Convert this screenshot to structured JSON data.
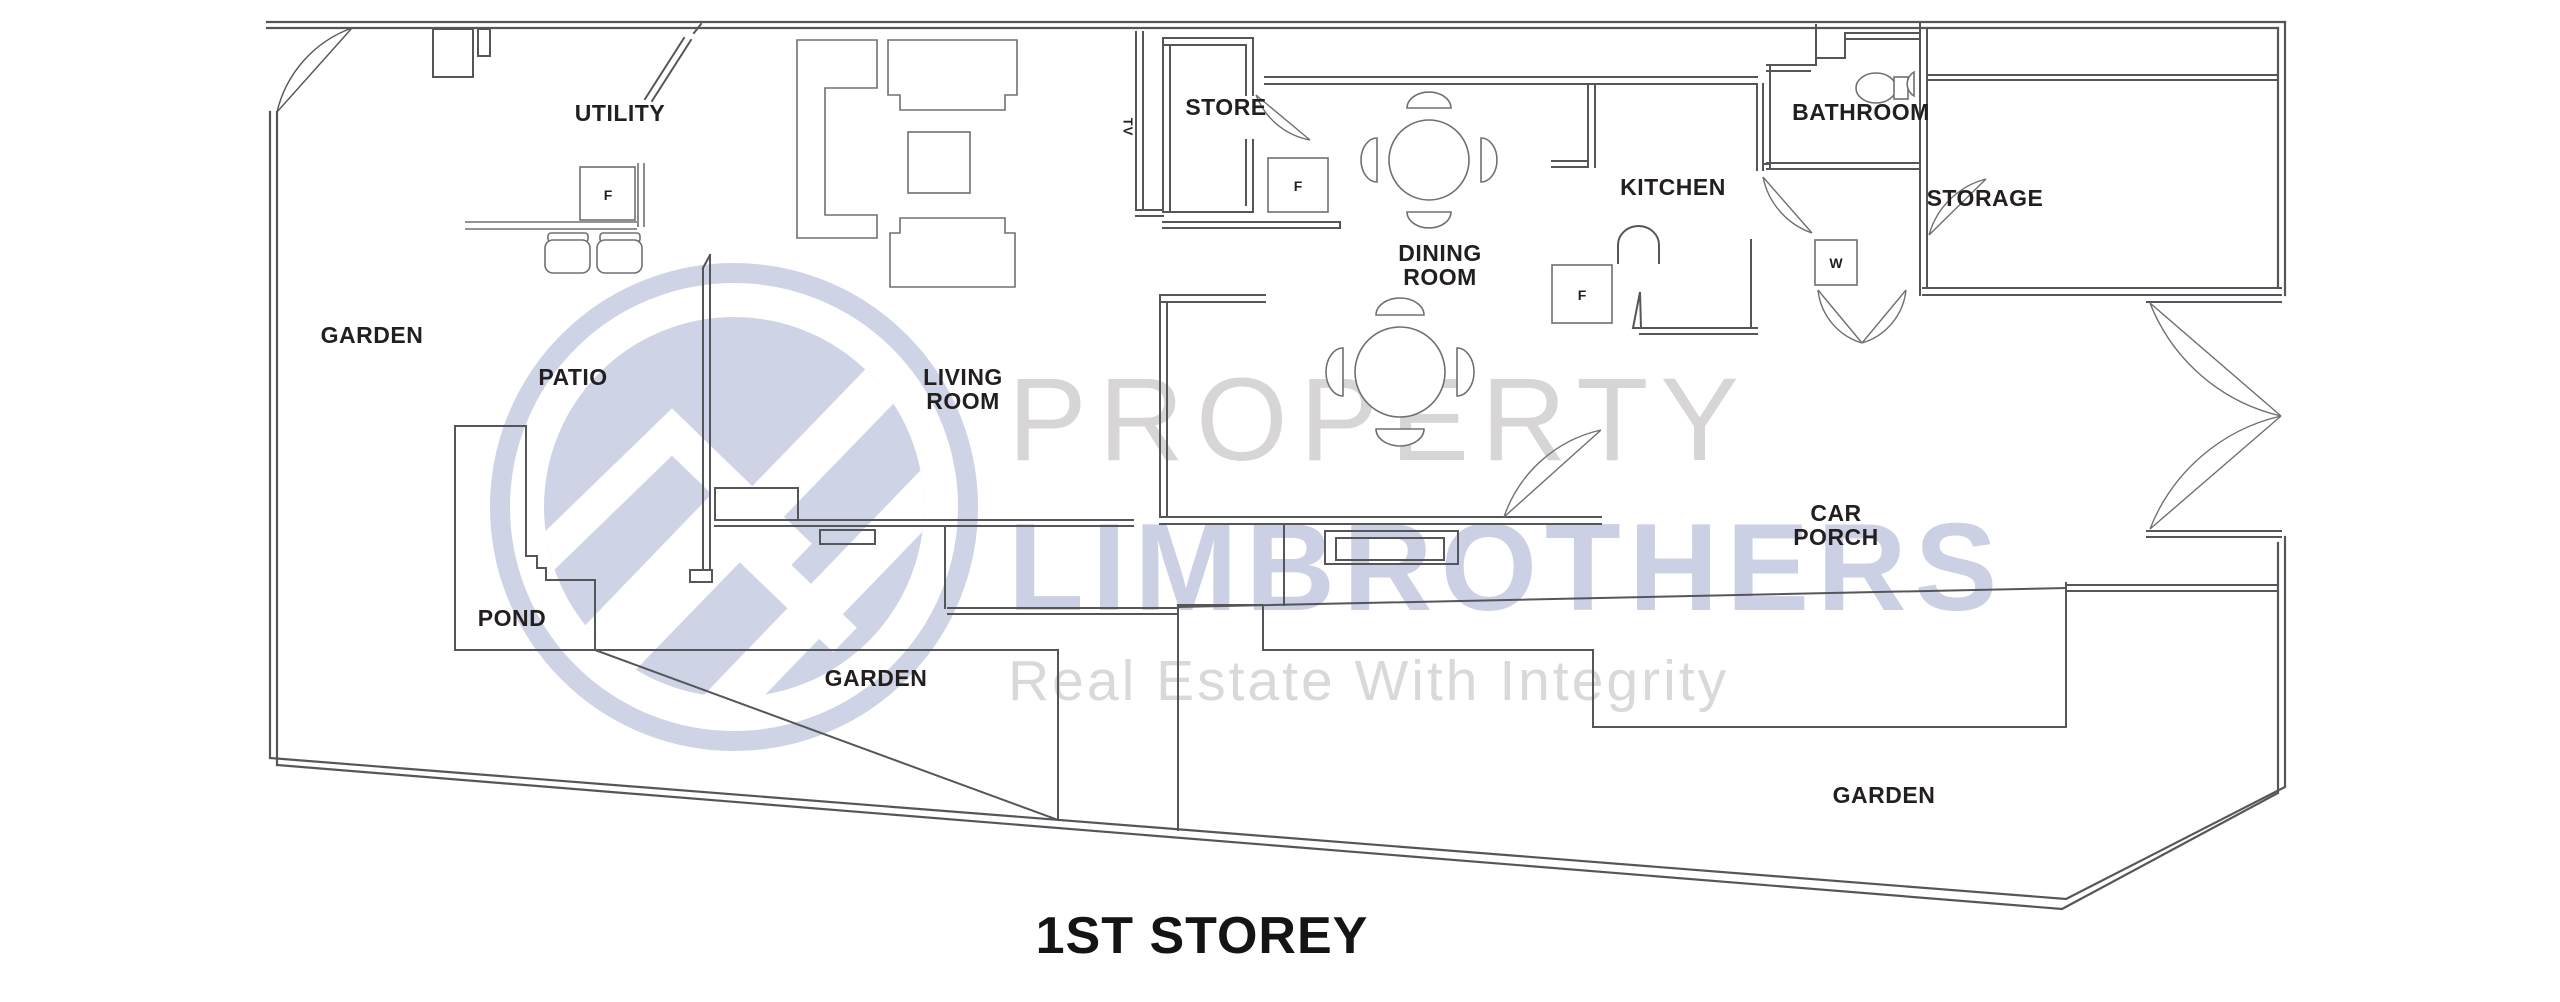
{
  "title": {
    "text": "1ST STOREY"
  },
  "watermark": {
    "brand_top": "PROPERTY",
    "brand_main": "LIMBROTHERS",
    "tagline": "Real Estate With Integrity",
    "logo_color": "#ced3e5",
    "brand_top_color": "#d8d5d6",
    "brand_main_color": "#cbd0e4",
    "tagline_color": "#d9d9d9"
  },
  "rooms": {
    "utility": "UTILITY",
    "garden_left": "GARDEN",
    "patio": "PATIO",
    "living_line1": "LIVING",
    "living_line2": "ROOM",
    "store": "STORE",
    "tv": "TV",
    "dining_line1": "DINING",
    "dining_line2": "ROOM",
    "kitchen": "KITCHEN",
    "bathroom": "BATHROOM",
    "storage": "STORAGE",
    "carporch_line1": "CAR",
    "carporch_line2": "PORCH",
    "pond": "POND",
    "garden_middle": "GARDEN",
    "garden_right": "GARDEN"
  },
  "appliances": {
    "fridge_label": "F",
    "washer_label": "W"
  },
  "colors": {
    "wall": "#55565a",
    "furniture": "#6f7073",
    "label": "#231f20",
    "title": "#161314"
  }
}
